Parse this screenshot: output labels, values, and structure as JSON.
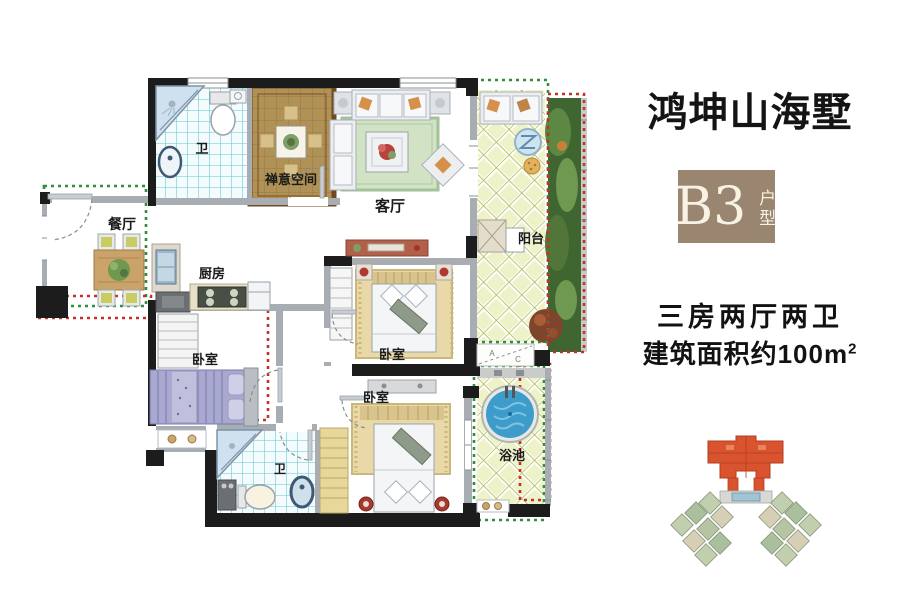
{
  "panel": {
    "title": "鸿坤山海墅",
    "badge": {
      "code": "B3",
      "label": "户型"
    },
    "spec_line1": "三房两厅两卫",
    "spec_line2": "建筑面积约100m",
    "spec_line2_sup": "2"
  },
  "floorplan": {
    "labels": {
      "bath_top": "卫",
      "zen": "禅意空间",
      "living": "客厅",
      "dining": "餐厅",
      "kitchen": "厨房",
      "bedroom_left": "卧室",
      "bedroom_mid": "卧室",
      "bedroom_bottom": "卧室",
      "balcony": "阳台",
      "bath_bottom": "卫",
      "pool": "浴池",
      "ac_a": "A",
      "ac_c": "C"
    }
  },
  "colors": {
    "wall": "#1c1c1c",
    "inner_outline_green": "#2f8f3c",
    "gift_outline_red": "#c23227",
    "badge_brown": "#9a8571",
    "pool_water": "#3e9ccb",
    "tile_line": "#63c5d2",
    "zen_floor": "#b09257",
    "lattice_bg": "#eef2c8",
    "highlight_building": "#d9542e"
  }
}
